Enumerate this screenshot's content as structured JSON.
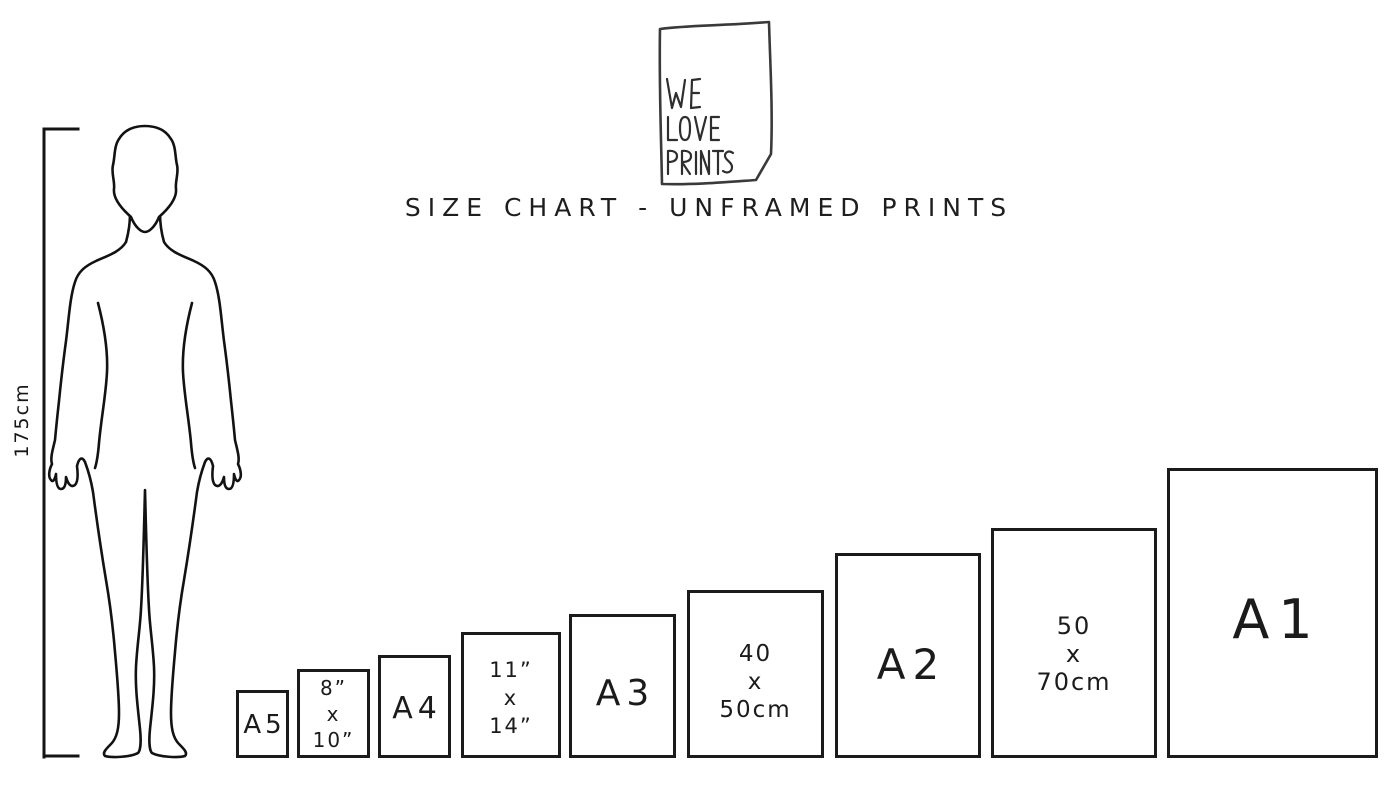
{
  "logo": {
    "line1": "WE",
    "line2": "LOVE",
    "line3": "PRINTS"
  },
  "title": "SIZE CHART - UNFRAMED PRINTS",
  "figure": {
    "height_label": "175cm"
  },
  "sizes": [
    {
      "name": "A5",
      "lines": [
        "A5"
      ]
    },
    {
      "name": "8x10in",
      "lines": [
        "8”",
        "x",
        "10”"
      ]
    },
    {
      "name": "A4",
      "lines": [
        "A4"
      ]
    },
    {
      "name": "11x14in",
      "lines": [
        "11”",
        "x",
        "14”"
      ]
    },
    {
      "name": "A3",
      "lines": [
        "A3"
      ]
    },
    {
      "name": "40x50cm",
      "lines": [
        "40",
        "x",
        "50cm"
      ]
    },
    {
      "name": "A2",
      "lines": [
        "A2"
      ]
    },
    {
      "name": "50x70cm",
      "lines": [
        "50",
        "x",
        "70cm"
      ]
    },
    {
      "name": "A1",
      "lines": [
        "A1"
      ]
    }
  ],
  "colors": {
    "ink": "#1b1b1b",
    "background": "#ffffff"
  }
}
